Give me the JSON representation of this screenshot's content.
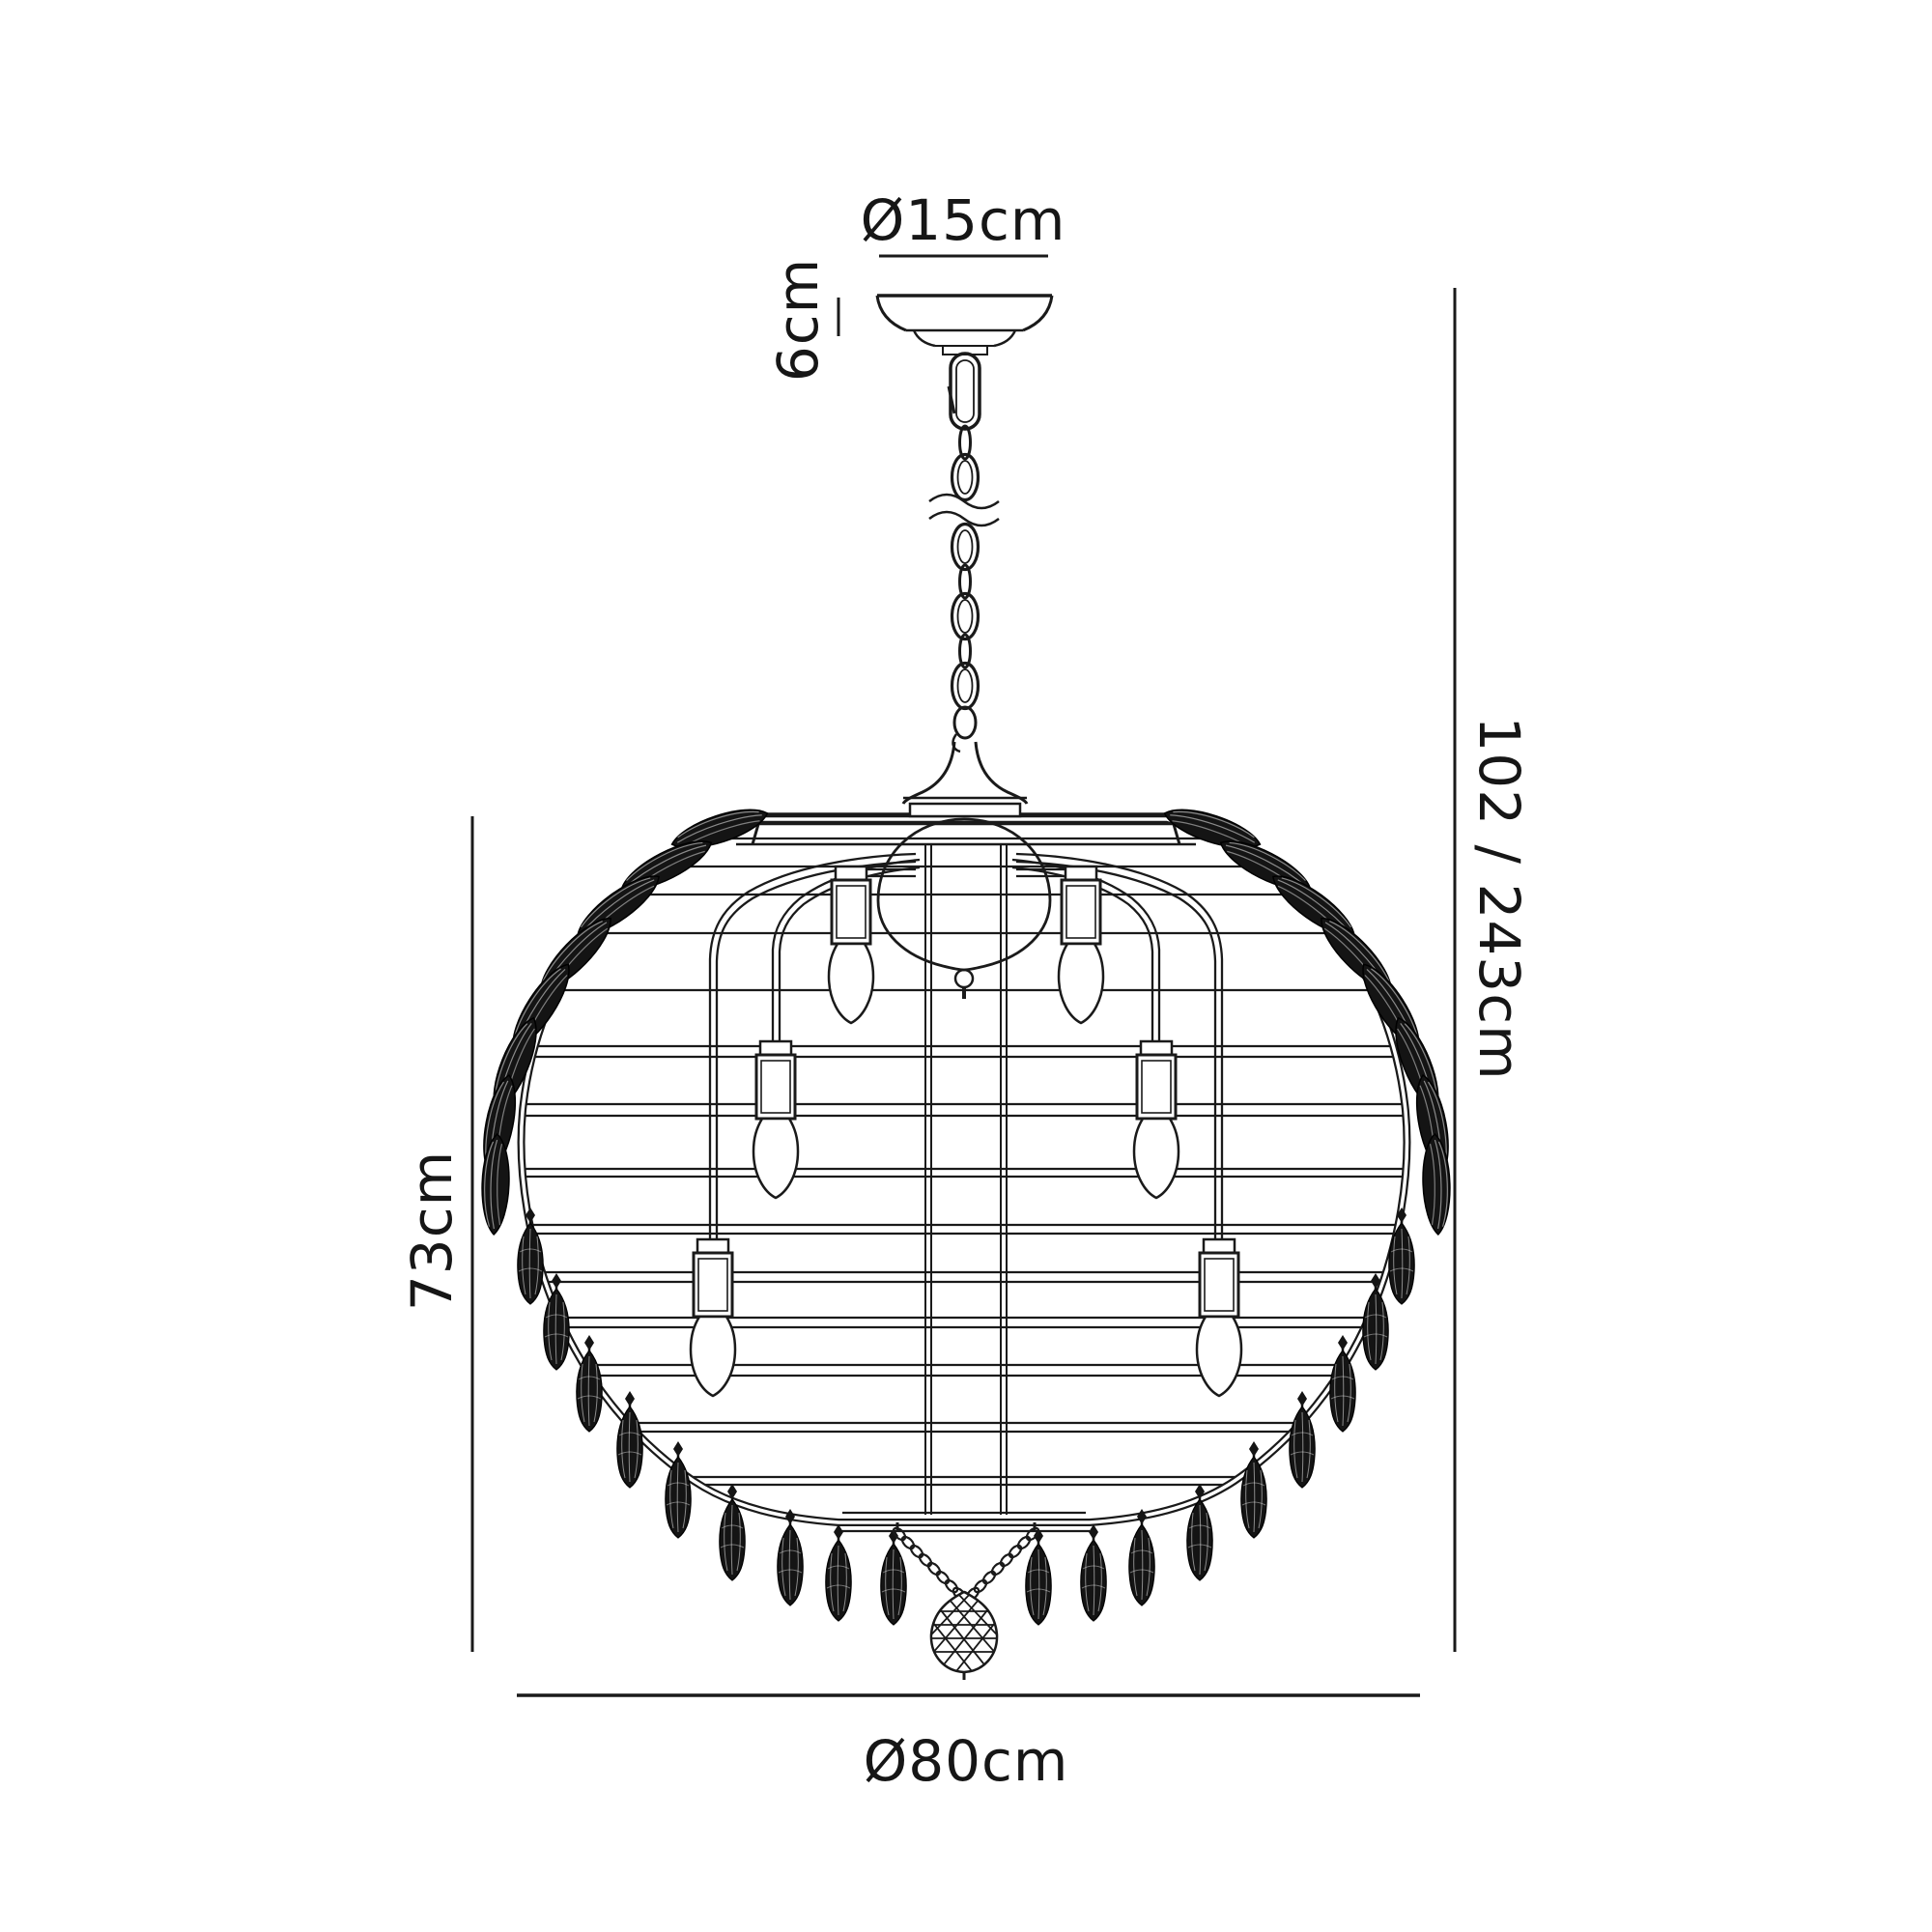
{
  "diagram": {
    "subject": "chandelier-dimension-drawing",
    "labels": {
      "canopy_diameter": "Ø15cm",
      "canopy_height": "6cm",
      "height_range": "102 / 243cm",
      "body_height": "73cm",
      "body_diameter": "Ø80cm"
    },
    "colors": {
      "ink": "#1a1a1a",
      "background": "#ffffff",
      "crystal_fill": "#141414"
    }
  }
}
